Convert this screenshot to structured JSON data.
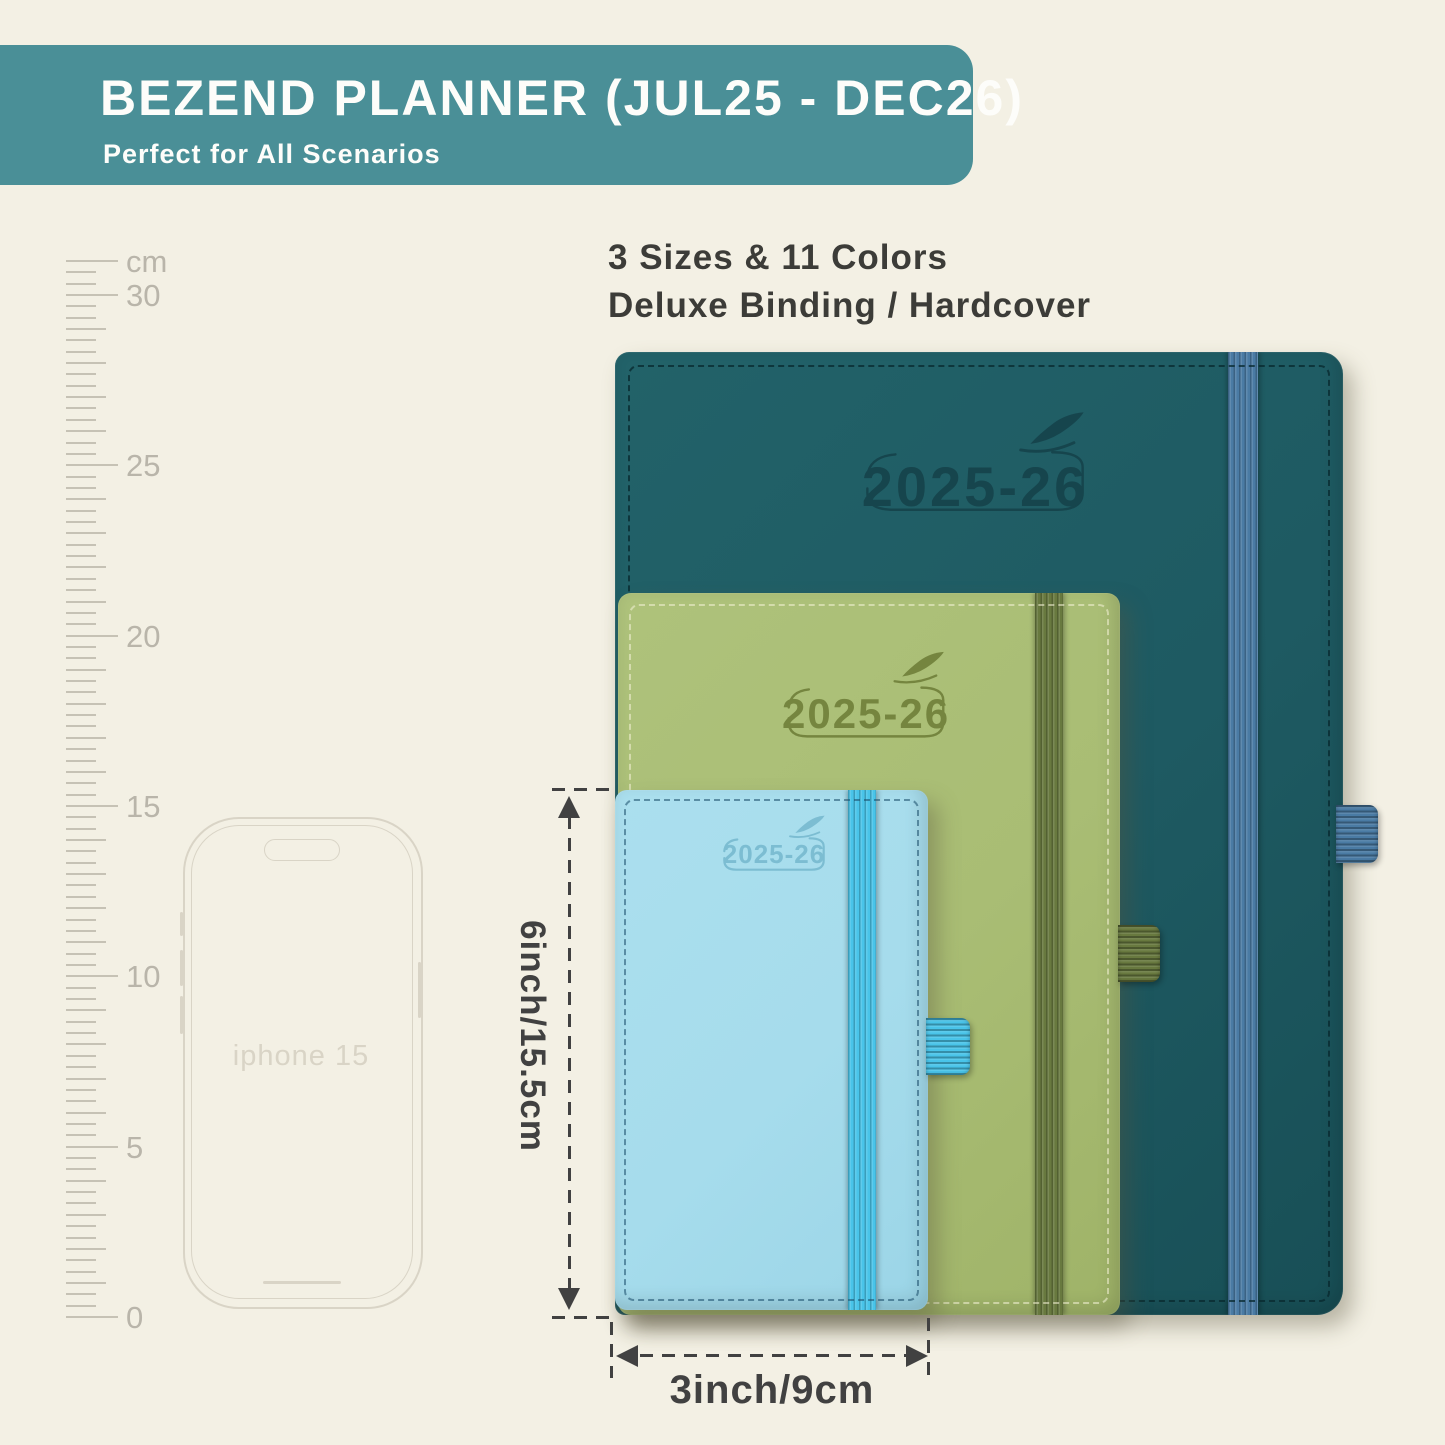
{
  "banner": {
    "title": "BEZEND PLANNER (JUL25 - DEC26)",
    "subtitle": "Perfect for All Scenarios"
  },
  "intro": {
    "line1": "3 Sizes & 11 Colors",
    "line2": "Deluxe Binding / Hardcover"
  },
  "ruler": {
    "unit": "cm",
    "labels": [
      {
        "text": "cm",
        "cm": 31
      },
      {
        "text": "30",
        "cm": 30
      },
      {
        "text": "25",
        "cm": 25
      },
      {
        "text": "20",
        "cm": 20
      },
      {
        "text": "15",
        "cm": 15
      },
      {
        "text": "10",
        "cm": 10
      },
      {
        "text": "5",
        "cm": 5
      },
      {
        "text": "0",
        "cm": 0
      }
    ]
  },
  "phone": {
    "label": "iphone 15"
  },
  "planners": [
    {
      "id": "large",
      "year": "2025-26",
      "cover": "#1e5a62",
      "band": "#4a7ba4",
      "logo": "#16454d"
    },
    {
      "id": "medium",
      "year": "2025-26",
      "cover": "#a9bd74",
      "band": "#68793f",
      "logo": "#75853f"
    },
    {
      "id": "small",
      "year": "2025-26",
      "cover": "#a6dcec",
      "band": "#49c4e9",
      "logo": "#7cbdd2"
    }
  ],
  "dimensions": {
    "height_label": "6inch/15.5cm",
    "width_label": "3inch/9cm"
  },
  "colors": {
    "background": "#f3f0e4",
    "banner_bg": "#4a8f97",
    "banner_text": "#fdfdfa",
    "body_text": "#3c3c38",
    "annotation": "#414141",
    "ruler": "#c6c2b5",
    "ruler_label": "#b9b5aa",
    "phone_outline": "#d9d4c6",
    "planner_large_cover": "#1e5a62",
    "planner_large_band": "#4a7ba4",
    "planner_large_logo": "#16454d",
    "planner_medium_cover": "#a9bd74",
    "planner_medium_band": "#68793f",
    "planner_medium_logo": "#75853f",
    "planner_small_cover": "#a6dcec",
    "planner_small_band": "#49c4e9",
    "planner_small_logo": "#7cbdd2"
  }
}
